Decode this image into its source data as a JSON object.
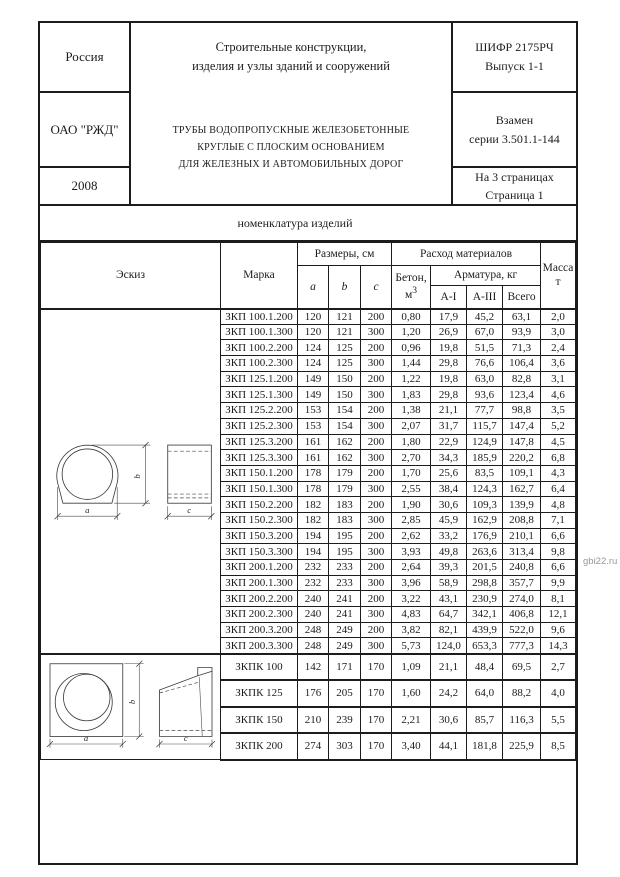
{
  "watermark": "gbi22.ru",
  "header": {
    "country": "Россия",
    "org": "ОАО \"РЖД\"",
    "year": "2008",
    "doc_title_line1": "Строительные конструкции,",
    "doc_title_line2": "изделия и узлы зданий и сооружений",
    "cipher_line1": "ШИФР 2175РЧ",
    "cipher_line2": "Выпуск 1-1",
    "subject_line1": "ТРУБЫ ВОДОПРОПУСКНЫЕ ЖЕЛЕЗОБЕТОННЫЕ",
    "subject_line2": "КРУГЛЫЕ С ПЛОСКИМ ОСНОВАНИЕМ",
    "subject_line3": "ДЛЯ ЖЕЛЕЗНЫХ И АВТОМОБИЛЬНЫХ ДОРОГ",
    "replaces_line1": "Взамен",
    "replaces_line2": "серии 3.501.1-144",
    "pages_line1": "На 3 страницах",
    "pages_line2": "Страница 1"
  },
  "section_title": "номенклатура изделий",
  "sketch_labels": {
    "a": "a",
    "b": "b",
    "c": "c"
  },
  "table": {
    "headers": {
      "sketch": "Эскиз",
      "mark": "Марка",
      "dimensions": "Размеры, см",
      "dim_a": "a",
      "dim_b": "b",
      "dim_c": "c",
      "materials": "Расход материалов",
      "concrete": "Бетон,",
      "concrete_unit_base": "м",
      "concrete_unit_sup": "3",
      "rebar": "Арматура, кг",
      "rebar_ai": "А-I",
      "rebar_aiii": "А-III",
      "rebar_total": "Всего",
      "mass_line1": "Масса",
      "mass_line2": "т"
    },
    "zkp_rows": [
      [
        "ЗКП 100.1.200",
        "120",
        "121",
        "200",
        "0,80",
        "17,9",
        "45,2",
        "63,1",
        "2,0"
      ],
      [
        "ЗКП 100.1.300",
        "120",
        "121",
        "300",
        "1,20",
        "26,9",
        "67,0",
        "93,9",
        "3,0"
      ],
      [
        "ЗКП 100.2.200",
        "124",
        "125",
        "200",
        "0,96",
        "19,8",
        "51,5",
        "71,3",
        "2,4"
      ],
      [
        "ЗКП 100.2.300",
        "124",
        "125",
        "300",
        "1,44",
        "29,8",
        "76,6",
        "106,4",
        "3,6"
      ],
      [
        "ЗКП 125.1.200",
        "149",
        "150",
        "200",
        "1,22",
        "19,8",
        "63,0",
        "82,8",
        "3,1"
      ],
      [
        "ЗКП 125.1.300",
        "149",
        "150",
        "300",
        "1,83",
        "29,8",
        "93,6",
        "123,4",
        "4,6"
      ],
      [
        "ЗКП 125.2.200",
        "153",
        "154",
        "200",
        "1,38",
        "21,1",
        "77,7",
        "98,8",
        "3,5"
      ],
      [
        "ЗКП 125.2.300",
        "153",
        "154",
        "300",
        "2,07",
        "31,7",
        "115,7",
        "147,4",
        "5,2"
      ],
      [
        "ЗКП 125.3.200",
        "161",
        "162",
        "200",
        "1,80",
        "22,9",
        "124,9",
        "147,8",
        "4,5"
      ],
      [
        "ЗКП 125.3.300",
        "161",
        "162",
        "300",
        "2,70",
        "34,3",
        "185,9",
        "220,2",
        "6,8"
      ],
      [
        "ЗКП 150.1.200",
        "178",
        "179",
        "200",
        "1,70",
        "25,6",
        "83,5",
        "109,1",
        "4,3"
      ],
      [
        "ЗКП 150.1.300",
        "178",
        "179",
        "300",
        "2,55",
        "38,4",
        "124,3",
        "162,7",
        "6,4"
      ],
      [
        "ЗКП 150.2.200",
        "182",
        "183",
        "200",
        "1,90",
        "30,6",
        "109,3",
        "139,9",
        "4,8"
      ],
      [
        "ЗКП 150.2.300",
        "182",
        "183",
        "300",
        "2,85",
        "45,9",
        "162,9",
        "208,8",
        "7,1"
      ],
      [
        "ЗКП 150.3.200",
        "194",
        "195",
        "200",
        "2,62",
        "33,2",
        "176,9",
        "210,1",
        "6,6"
      ],
      [
        "ЗКП 150.3.300",
        "194",
        "195",
        "300",
        "3,93",
        "49,8",
        "263,6",
        "313,4",
        "9,8"
      ],
      [
        "ЗКП 200.1.200",
        "232",
        "233",
        "200",
        "2,64",
        "39,3",
        "201,5",
        "240,8",
        "6,6"
      ],
      [
        "ЗКП 200.1.300",
        "232",
        "233",
        "300",
        "3,96",
        "58,9",
        "298,8",
        "357,7",
        "9,9"
      ],
      [
        "ЗКП 200.2.200",
        "240",
        "241",
        "200",
        "3,22",
        "43,1",
        "230,9",
        "274,0",
        "8,1"
      ],
      [
        "ЗКП 200.2.300",
        "240",
        "241",
        "300",
        "4,83",
        "64,7",
        "342,1",
        "406,8",
        "12,1"
      ],
      [
        "ЗКП 200.3.200",
        "248",
        "249",
        "200",
        "3,82",
        "82,1",
        "439,9",
        "522,0",
        "9,6"
      ],
      [
        "ЗКП 200.3.300",
        "248",
        "249",
        "300",
        "5,73",
        "124,0",
        "653,3",
        "777,3",
        "14,3"
      ]
    ],
    "zkpk_rows": [
      [
        "ЗКПК 100",
        "142",
        "171",
        "170",
        "1,09",
        "21,1",
        "48,4",
        "69,5",
        "2,7"
      ],
      [
        "ЗКПК 125",
        "176",
        "205",
        "170",
        "1,60",
        "24,2",
        "64,0",
        "88,2",
        "4,0"
      ],
      [
        "ЗКПК 150",
        "210",
        "239",
        "170",
        "2,21",
        "30,6",
        "85,7",
        "116,3",
        "5,5"
      ],
      [
        "ЗКПК 200",
        "274",
        "303",
        "170",
        "3,40",
        "44,1",
        "181,8",
        "225,9",
        "8,5"
      ]
    ]
  }
}
